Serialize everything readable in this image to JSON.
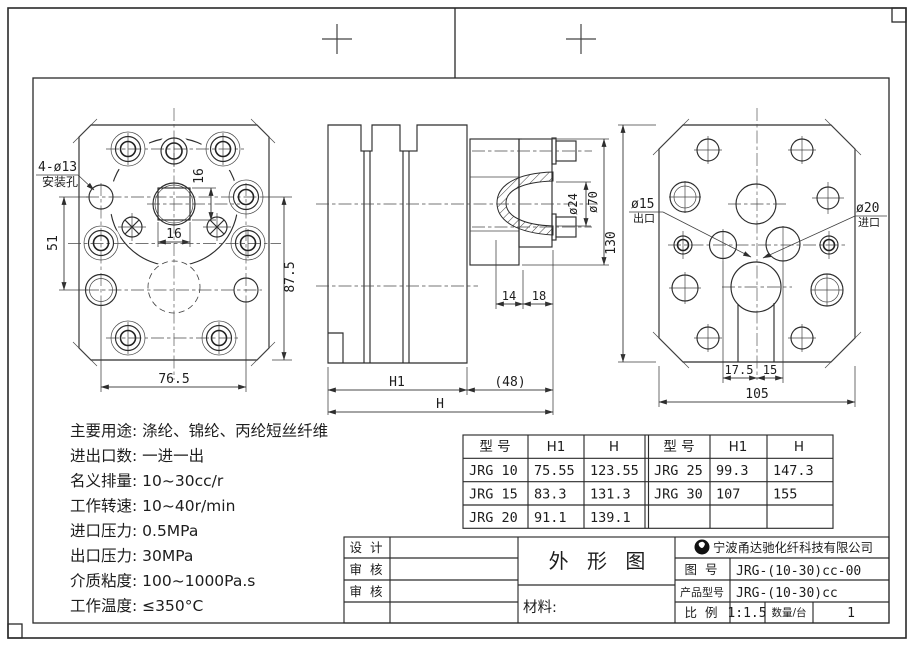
{
  "specs": [
    "主要用途: 涤纶、锦纶、丙纶短丝纤维",
    "进出口数: 一进一出",
    "名义排量: 10~30cc/r",
    "工作转速: 10~40r/min",
    "进口压力: 0.5MPa",
    "出口压力: 30MPa",
    "介质粘度: 100~1000Pa.s",
    "工作温度: ≤350°C"
  ],
  "spec_table": {
    "left": {
      "headers": [
        "型 号",
        "H1",
        "H"
      ],
      "rows": [
        [
          "JRG 10",
          "75.55",
          "123.55"
        ],
        [
          "JRG 15",
          "83.3",
          "131.3"
        ],
        [
          "JRG 20",
          "91.1",
          "139.1"
        ]
      ]
    },
    "right": {
      "headers": [
        "型 号",
        "H1",
        "H"
      ],
      "rows": [
        [
          "JRG 25",
          "99.3",
          "147.3"
        ],
        [
          "JRG 30",
          "107",
          "155"
        ]
      ]
    }
  },
  "dims": {
    "front": {
      "mount_count_label": "4-ø13",
      "mount_hole_label": "安装孔",
      "square_width": "16",
      "square_height": "16",
      "hole_v_spacing": "51",
      "height_ref": "87.5",
      "hole_h_spacing": "76.5"
    },
    "side": {
      "shaft_dia": "ø24",
      "flange_dia": "ø70",
      "nose_len": "14",
      "plate_len": "18",
      "body_len": "H1",
      "ext_len": "(48)",
      "total_len": "H"
    },
    "back": {
      "plate_height": "130",
      "outlet_dia": "ø15",
      "outlet_label": "出口",
      "inlet_dia": "ø20",
      "inlet_label": "进口",
      "port_off_left": "17.5",
      "port_off_right": "15",
      "plate_width": "105"
    }
  },
  "title_block": {
    "design_label": "设 计",
    "check1_label": "审 核",
    "check2_label": "审 核",
    "title": "外 形 图",
    "material_label": "材料:",
    "company": "宁波甬达驰化纤科技有限公司",
    "drawing_no_label": "图 号",
    "drawing_no": "JRG-(10-30)cc-00",
    "product_model_label": "产品型号",
    "product_model": "JRG-(10-30)cc",
    "scale_label": "比 例",
    "scale_value": "1:1.5",
    "qty_label": "数量/台",
    "qty_value": "1"
  }
}
